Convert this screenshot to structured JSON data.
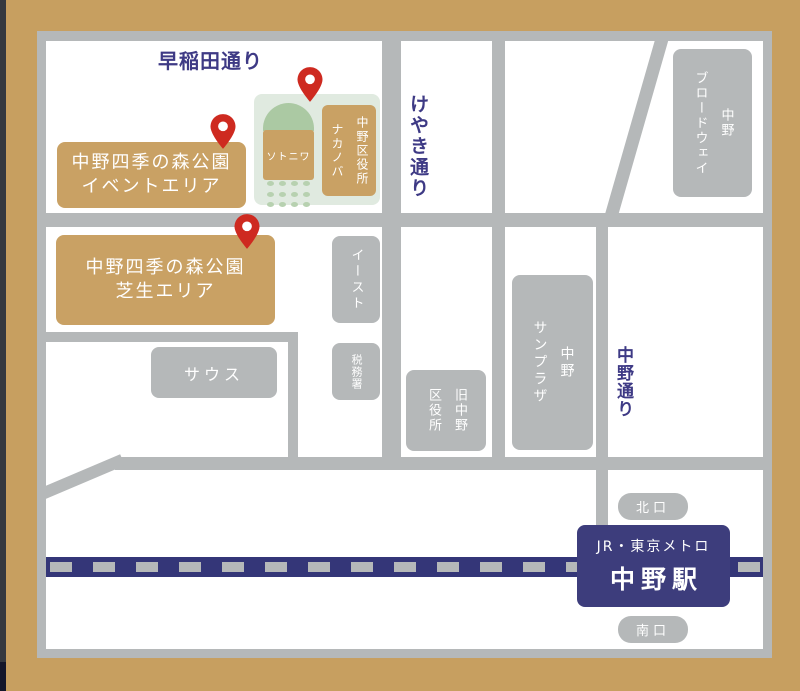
{
  "streets": {
    "waseda": "早稲田通り",
    "keyaki": "けやき通り",
    "nakano": "中野通り"
  },
  "park": {
    "event_area": {
      "line1": "中野四季の森公園",
      "line2": "イベントエリア"
    },
    "lawn_area": {
      "line1": "中野四季の森公園",
      "line2": "芝生エリア"
    },
    "sotoniwa": "ソトニワ"
  },
  "buildings": {
    "ward_office": {
      "col1": "中野区役所",
      "col2": "ナカノバ"
    },
    "broadway": {
      "col1": "中野",
      "col2": "ブロードウェイ"
    },
    "east": "イースト",
    "south": "サウス",
    "tax_office": "税務署",
    "former_ward_office": {
      "col1": "旧中野",
      "col2": "区役所"
    },
    "sunplaza": {
      "col1": "中野",
      "col2": "サンプラザ"
    }
  },
  "station": {
    "operator": "JR・東京メトロ",
    "name": "中野駅",
    "north_exit": "北口",
    "south_exit": "南口"
  },
  "pins": {
    "count": 3
  },
  "colors": {
    "frame_tan": "#c79f60",
    "edge_dark": "#35383f",
    "road_gray": "#b5b8b9",
    "station_navy": "#3d3d7c",
    "rail_navy": "#343678",
    "street_label_navy": "#3e3a85",
    "park_tan": "#c9a164",
    "pin_red": "#ce2a20",
    "green_panel": "#e0eae0",
    "green_dome": "#abc9a3",
    "green_dot": "#b7d1b0",
    "text_white": "#ffffff"
  }
}
